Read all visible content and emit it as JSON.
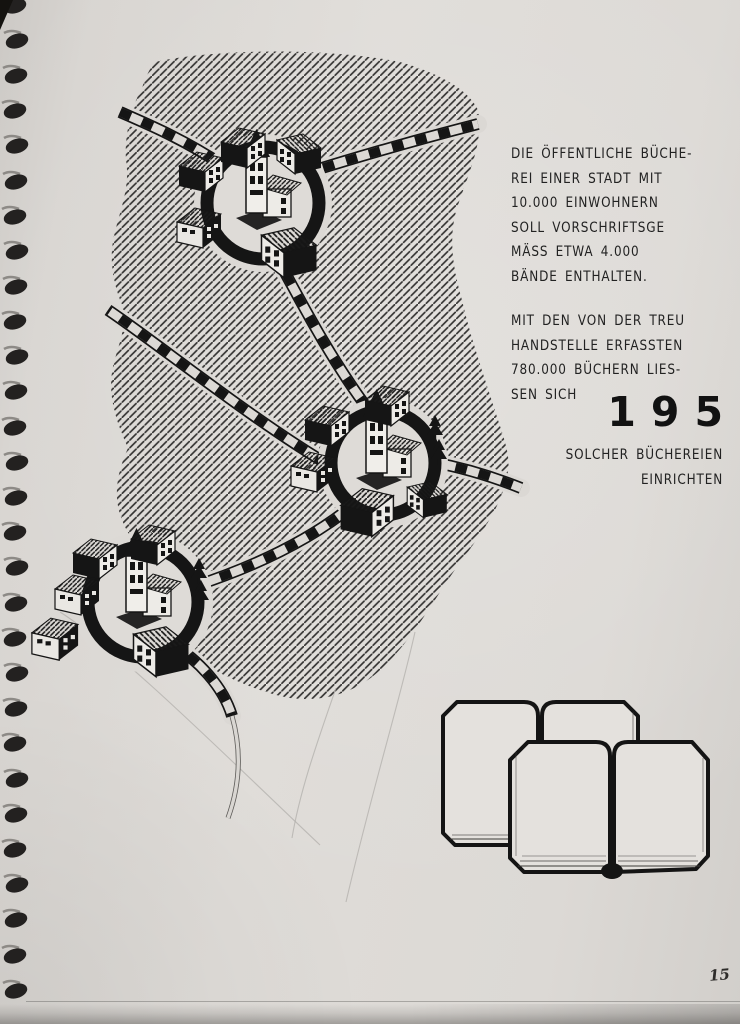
{
  "page": {
    "number": "15"
  },
  "colors": {
    "paper": "#dbd8d4",
    "ink": "#151515"
  },
  "paragraphs": {
    "intro": [
      "DIE ÖFFENTLICHE BÜCHE-",
      "REI EINER STADT MIT",
      "10.000 EINWOHNERN",
      "SOLL VORSCHRIFTSGE",
      "MÄSS ETWA 4.000",
      "BÄNDE ENTHALTEN."
    ],
    "treuhand": [
      "MIT DEN VON DER TREU",
      "HANDSTELLE ERFASSTEN",
      "780.000 BÜCHERN LIES-",
      "SEN SICH"
    ]
  },
  "statistic": {
    "value": "195",
    "caption": [
      "SOLCHER BÜCHEREIEN",
      "EINRICHTEN"
    ]
  },
  "illustration": {
    "icons": [
      "town-circle-icon",
      "dashed-road-icon",
      "church-icon",
      "house-icon",
      "pine-tree-icon",
      "open-books-icon",
      "spiral-binding-icon"
    ]
  }
}
